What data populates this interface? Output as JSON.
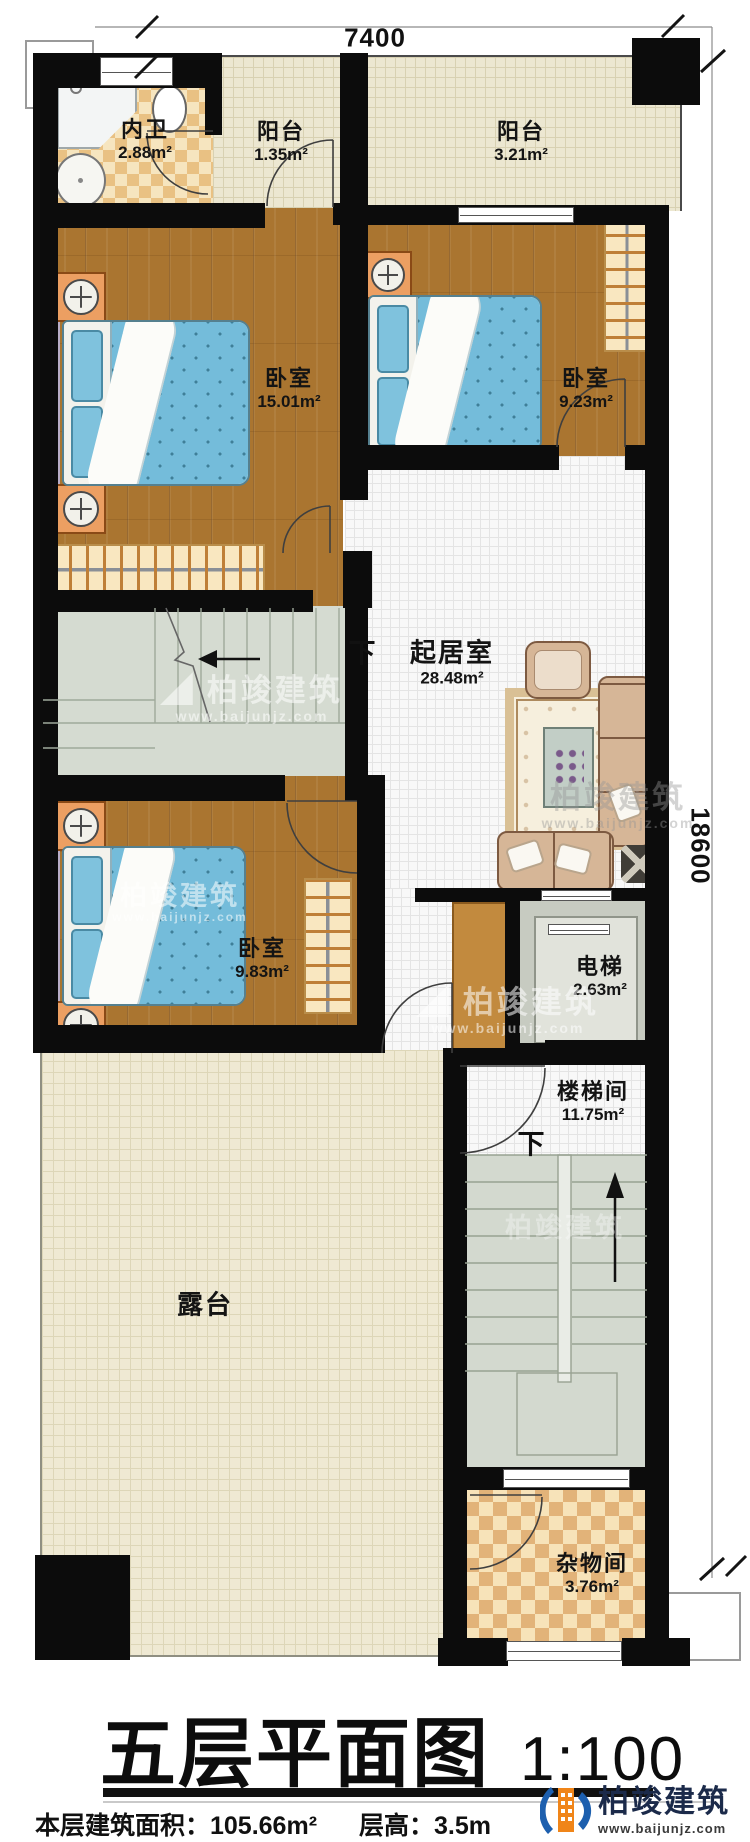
{
  "title": {
    "main": "五层平面图",
    "scale": "1:100"
  },
  "footer": {
    "area_text": "本层建筑面积：105.66m²",
    "height_text": "层高：3.5m"
  },
  "dimensions": {
    "width": "7400",
    "height": "18600"
  },
  "annotations": {
    "down": "下"
  },
  "watermark": {
    "icon": "◢",
    "brand": "柏竣建筑",
    "url": "www.baijunjz.com"
  },
  "brand": {
    "name": "柏竣建筑",
    "url": "www.baijunjz.com"
  },
  "rooms": [
    {
      "id": "bathroom",
      "name": "内卫",
      "area": "2.88m²"
    },
    {
      "id": "balcony1",
      "name": "阳台",
      "area": "1.35m²"
    },
    {
      "id": "balcony2",
      "name": "阳台",
      "area": "3.21m²"
    },
    {
      "id": "bedroom1",
      "name": "卧室",
      "area": "15.01m²"
    },
    {
      "id": "bedroom2",
      "name": "卧室",
      "area": "9.23m²"
    },
    {
      "id": "living",
      "name": "起居室",
      "area": "28.48m²"
    },
    {
      "id": "bedroom3",
      "name": "卧室",
      "area": "9.83m²"
    },
    {
      "id": "elevator",
      "name": "电梯",
      "area": "2.63m²"
    },
    {
      "id": "stairwell",
      "name": "楼梯间",
      "area": "11.75m²"
    },
    {
      "id": "terrace",
      "name": "露台",
      "area": ""
    },
    {
      "id": "storage",
      "name": "杂物间",
      "area": "3.76m²"
    }
  ],
  "colors": {
    "wall": "#0c0c0c",
    "wood_floor": "#aa7530",
    "balcony_tile": "#ece7d1",
    "living_tile": "#f8f8f8",
    "checker_tan": "#e9c183",
    "stairs": "#d5dbd1",
    "bed_blue": "#74bcda",
    "sofa_tan": "#d6b697",
    "brand_blue": "#1d5fae",
    "brand_orange": "#f08519"
  }
}
